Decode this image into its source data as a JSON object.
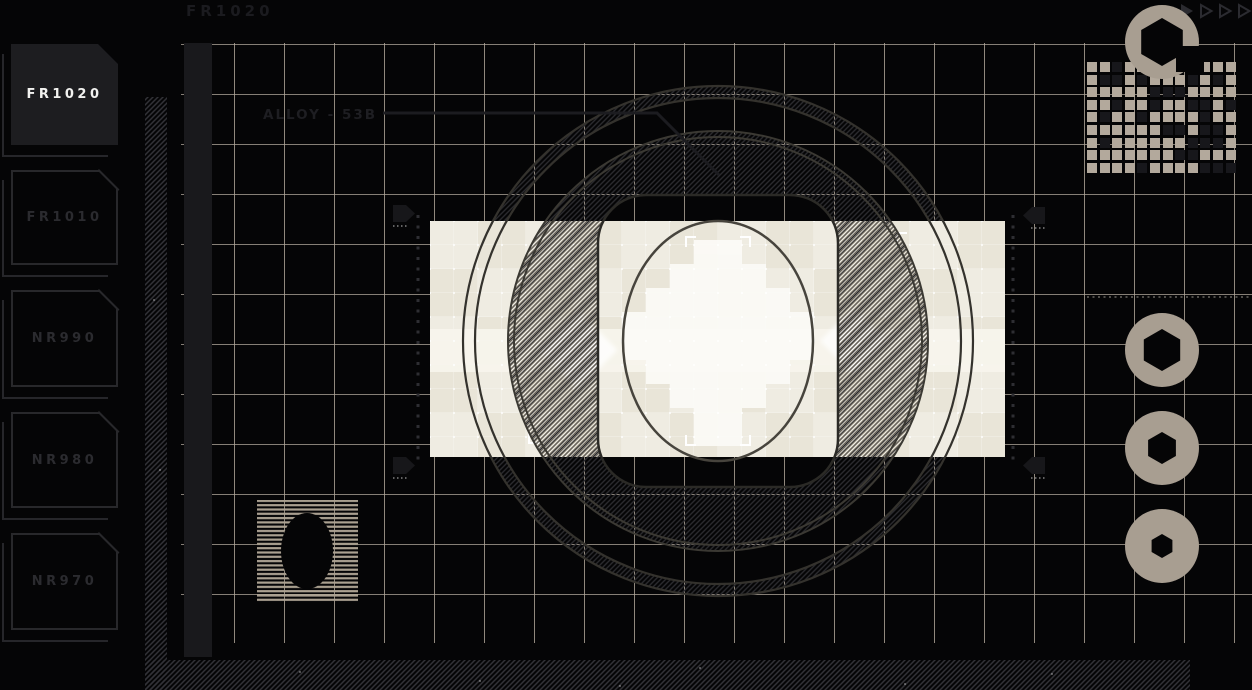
{
  "header": {
    "title": "FR1020"
  },
  "toolbar": {
    "icons": [
      "play-filled-icon",
      "play-outline-icon",
      "play-outline-icon",
      "play-outline-icon"
    ]
  },
  "sidebar": {
    "items": [
      {
        "label": "FR1020",
        "active": true
      },
      {
        "label": "FR1010",
        "active": false
      },
      {
        "label": "NR990",
        "active": false
      },
      {
        "label": "NR980",
        "active": false
      },
      {
        "label": "NR970",
        "active": false
      }
    ]
  },
  "drawing": {
    "annotation": "ALLOY - 53B"
  },
  "qr": {
    "cols": 12,
    "rows": 9,
    "matrix": [
      [
        1,
        1,
        0,
        1,
        1,
        1,
        0,
        1,
        0,
        1,
        1,
        1
      ],
      [
        1,
        0,
        0,
        1,
        0,
        1,
        1,
        1,
        0,
        1,
        0,
        1
      ],
      [
        1,
        1,
        1,
        1,
        1,
        0,
        0,
        0,
        1,
        1,
        1,
        1
      ],
      [
        1,
        1,
        0,
        1,
        1,
        0,
        1,
        1,
        0,
        0,
        1,
        0
      ],
      [
        1,
        0,
        1,
        1,
        0,
        1,
        1,
        1,
        1,
        0,
        1,
        1
      ],
      [
        1,
        1,
        1,
        1,
        1,
        1,
        0,
        0,
        1,
        0,
        0,
        1
      ],
      [
        1,
        0,
        1,
        1,
        1,
        1,
        1,
        1,
        0,
        0,
        0,
        1
      ],
      [
        1,
        1,
        1,
        1,
        1,
        1,
        1,
        0,
        0,
        1,
        1,
        1
      ],
      [
        1,
        1,
        1,
        1,
        0,
        1,
        1,
        1,
        1,
        0,
        0,
        0
      ]
    ]
  },
  "right_rail": {
    "icons": [
      "bolt-ring-notched-icon",
      "bolt-ring-icon",
      "bolt-ring-icon",
      "bolt-ring-icon"
    ],
    "hex_hole_sizes": [
      24,
      21,
      16,
      12
    ]
  },
  "colors": {
    "background": "#050506",
    "grid": "#b2a89b",
    "panel_cream": "#e9e5d8",
    "highlight_white": "#fbfaf5",
    "ui_dark": "#1d1d20",
    "outline": "#28282b",
    "text_dim": "#2b2b2f",
    "text_active": "#f2f2f0",
    "bolt": "#a89e91"
  }
}
